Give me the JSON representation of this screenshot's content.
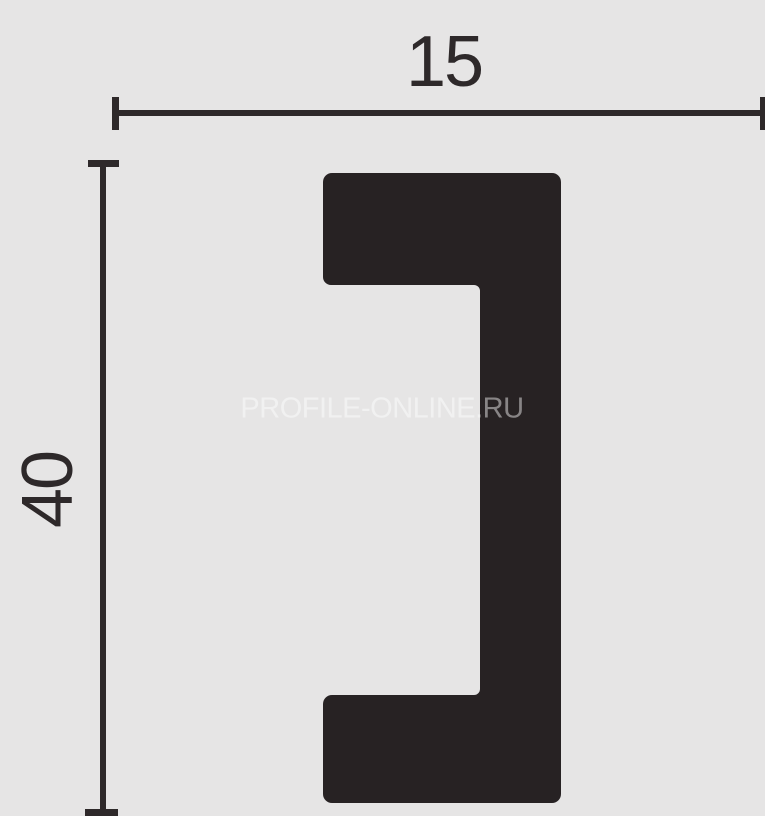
{
  "diagram": {
    "type": "profile-cross-section-drawing",
    "watermark": "PROFILE-ONLINE.RU",
    "dimensions": {
      "width": "15",
      "height": "40"
    },
    "shape": "c-channel-profile-opening-left",
    "colors": {
      "background": "#e6e5e5",
      "profile_fill": "#272223",
      "dimension_lines": "#2e292a",
      "watermark_color": "rgba(255,255,255,0.45)"
    }
  }
}
